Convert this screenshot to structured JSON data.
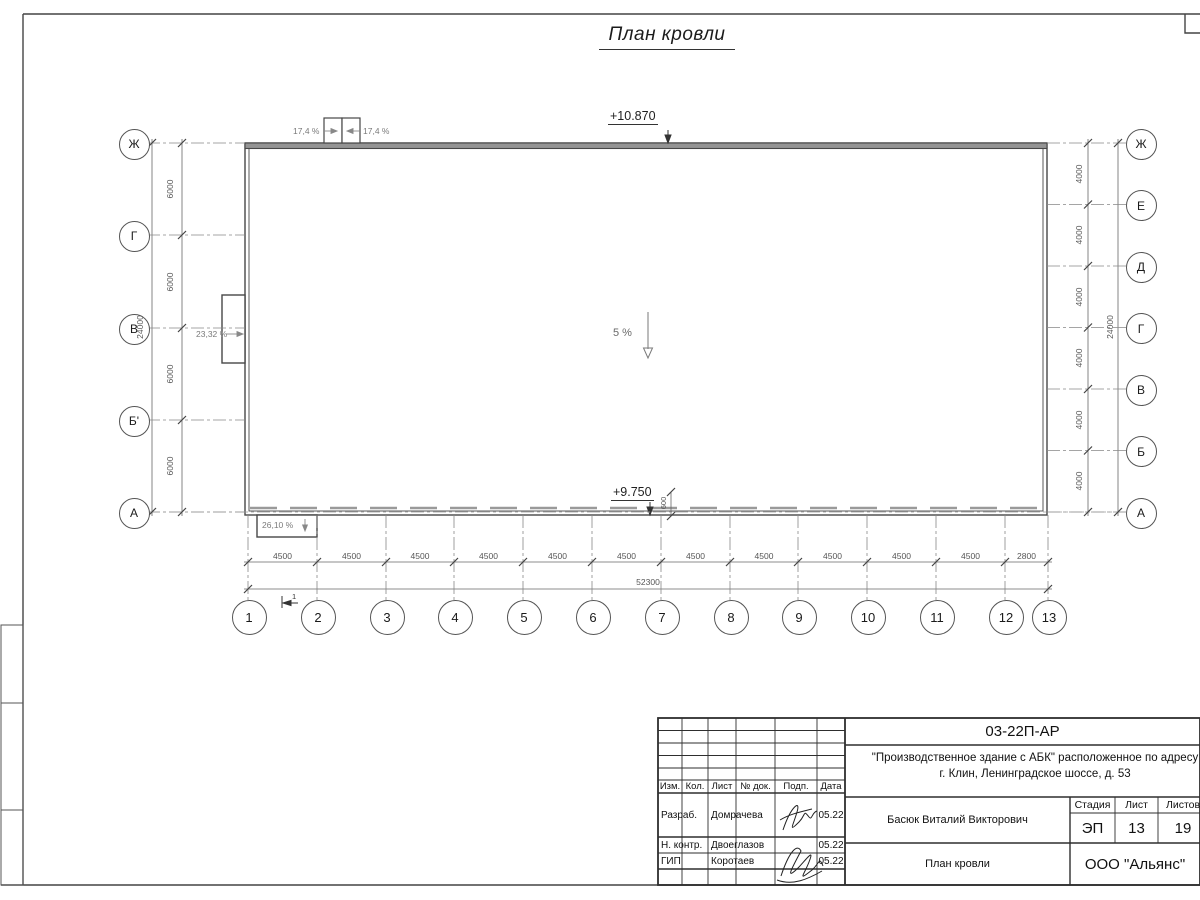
{
  "page_title": "План кровли",
  "plan": {
    "elevations": {
      "top": "+10.870",
      "bottom": "+9.750"
    },
    "slopes": {
      "center": "5 %",
      "left": "23,32 %",
      "bottom_left": "26,10 %",
      "top_left": "17,4 %",
      "top_right": "17,4 %"
    },
    "parapet_dim": "600",
    "section_mark": "1",
    "axes": {
      "left": [
        "Ж",
        "Г",
        "В",
        "Б'",
        "А"
      ],
      "right": [
        "Ж",
        "Е",
        "Д",
        "Г",
        "В",
        "Б",
        "А"
      ],
      "bottom": [
        "1",
        "2",
        "3",
        "4",
        "5",
        "6",
        "7",
        "8",
        "9",
        "10",
        "11",
        "12",
        "13"
      ]
    },
    "dimensions": {
      "left_segments": [
        "6000",
        "6000",
        "6000",
        "6000"
      ],
      "left_total": "24000",
      "right_segments": [
        "4000",
        "4000",
        "4000",
        "4000",
        "4000",
        "4000"
      ],
      "right_total": "24000",
      "bottom_segments": [
        "4500",
        "4500",
        "4500",
        "4500",
        "4500",
        "4500",
        "4500",
        "4500",
        "4500",
        "4500",
        "4500",
        "2800"
      ],
      "bottom_total": "52300"
    }
  },
  "title_block": {
    "doc_number": "03-22П-АР",
    "project_name_line1": "\"Производственное здание с АБК\" расположенное по адресу",
    "project_name_line2": "г. Клин, Ленинградское шоссе, д. 53",
    "revision_headers": [
      "Изм.",
      "Кол.",
      "Лист",
      "№ док.",
      "Подп.",
      "Дата"
    ],
    "personnel": [
      {
        "role": "Разраб.",
        "name": "Домрачева",
        "date": "05.22"
      },
      {
        "role": "Н. контр.",
        "name": "Двоеглазов",
        "date": "05.22"
      },
      {
        "role": "ГИП",
        "name": "Коротаев",
        "date": "05.22"
      }
    ],
    "approved_by": "Басюк Виталий Викторович",
    "stage": {
      "label": "Стадия",
      "value": "ЭП"
    },
    "sheet": {
      "label": "Лист",
      "value": "13"
    },
    "sheets": {
      "label": "Листов",
      "value": "19"
    },
    "sheet_title": "План кровли",
    "company": "ООО \"Альянс\""
  }
}
